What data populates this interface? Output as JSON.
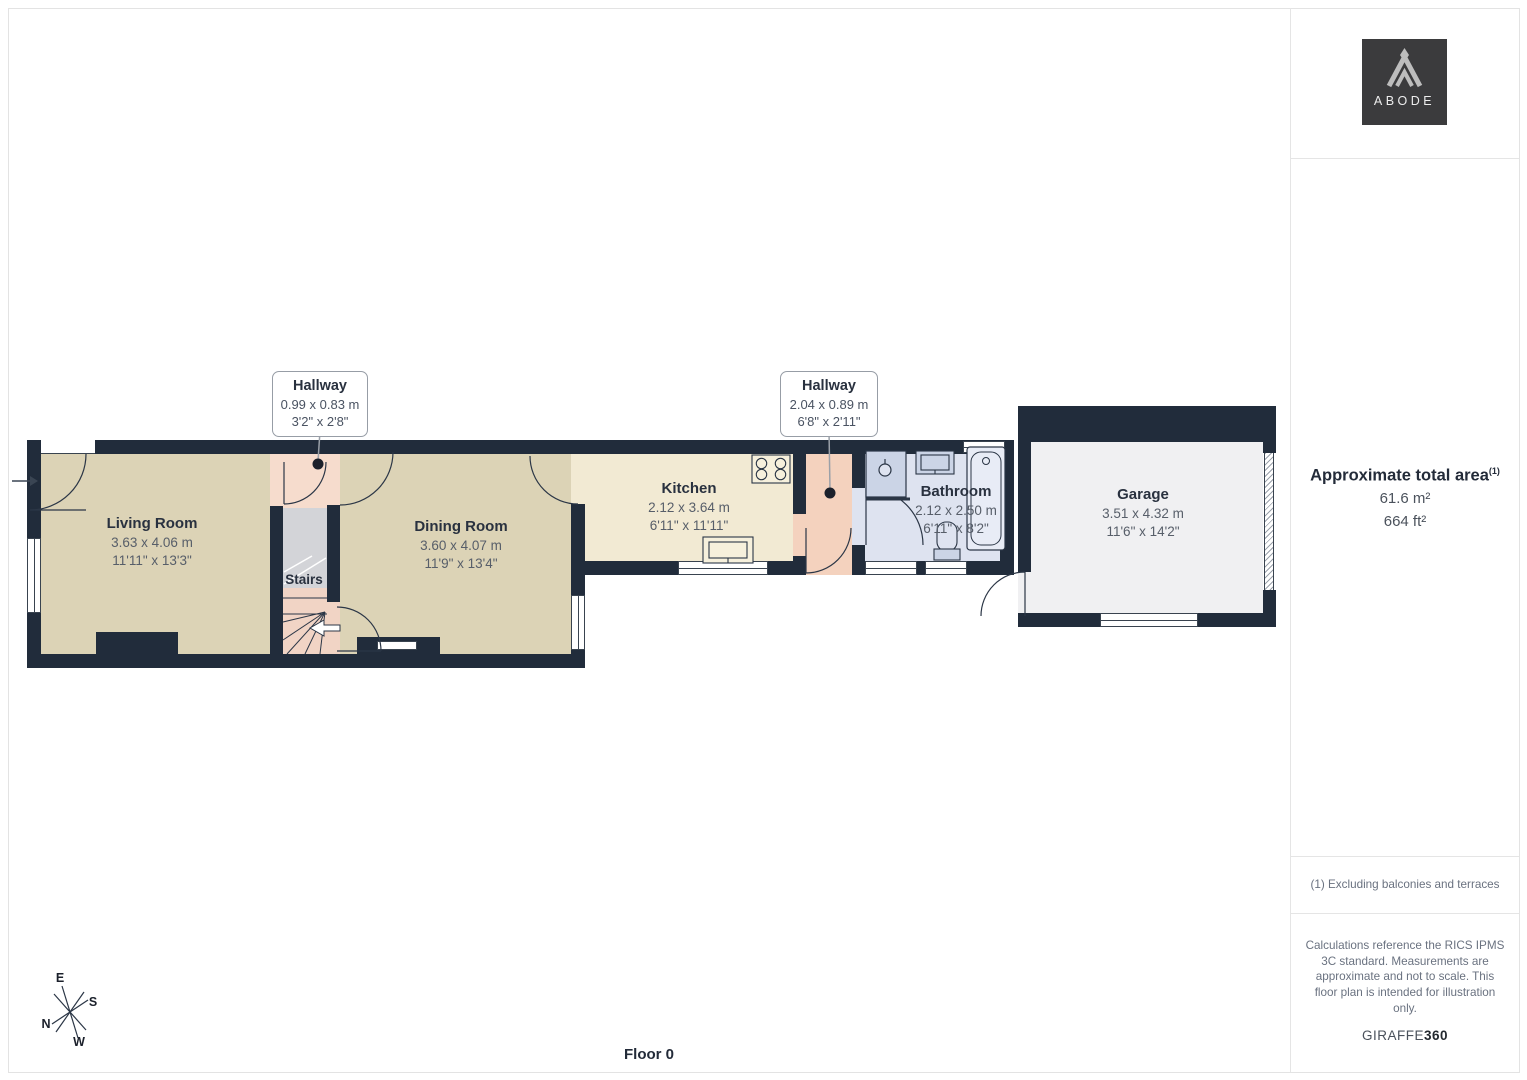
{
  "page": {
    "floor_label": "Floor 0"
  },
  "logo": {
    "text": "ABODE"
  },
  "sidebar": {
    "area_title": "Approximate total area",
    "area_ref": "(1)",
    "area_metric": "61.6 m²",
    "area_imperial": "664 ft²",
    "footnote": "(1) Excluding balconies and terraces",
    "disclaimer": "Calculations reference the RICS IPMS 3C standard. Measurements are approximate and not to scale. This floor plan is intended for illustration only.",
    "brand": "GIRAFFE",
    "brand_suffix": "360"
  },
  "compass": {
    "n": "N",
    "e": "E",
    "s": "S",
    "w": "W"
  },
  "rooms": {
    "living": {
      "name": "Living Room",
      "metric": "3.63 x 4.06 m",
      "imperial": "11'11\" x 13'3\""
    },
    "dining": {
      "name": "Dining Room",
      "metric": "3.60 x 4.07 m",
      "imperial": "11'9\" x 13'4\""
    },
    "kitchen": {
      "name": "Kitchen",
      "metric": "2.12 x 3.64 m",
      "imperial": "6'11\" x 11'11\""
    },
    "bathroom": {
      "name": "Bathroom",
      "metric": "2.12 x 2.50 m",
      "imperial": "6'11\" x 8'2\""
    },
    "garage": {
      "name": "Garage",
      "metric": "3.51 x 4.32 m",
      "imperial": "11'6\" x 14'2\""
    },
    "stairs": {
      "name": "Stairs"
    }
  },
  "callouts": {
    "hallway1": {
      "name": "Hallway",
      "metric": "0.99 x 0.83 m",
      "imperial": "3'2\" x 2'8\""
    },
    "hallway2": {
      "name": "Hallway",
      "metric": "2.04 x 0.89 m",
      "imperial": "6'8\" x 2'11\""
    }
  },
  "colors": {
    "wall": "#212C3B",
    "living_floor": "#DCD3B6",
    "kitchen_floor": "#F2EAD3",
    "hallway_floor": "#F6DCCD",
    "stairs_floor": "#D3D4D8",
    "bathroom_floor": "#DEE3F0",
    "garage_floor": "#F0F0F2",
    "logo_bg": "#3B3B3D"
  }
}
